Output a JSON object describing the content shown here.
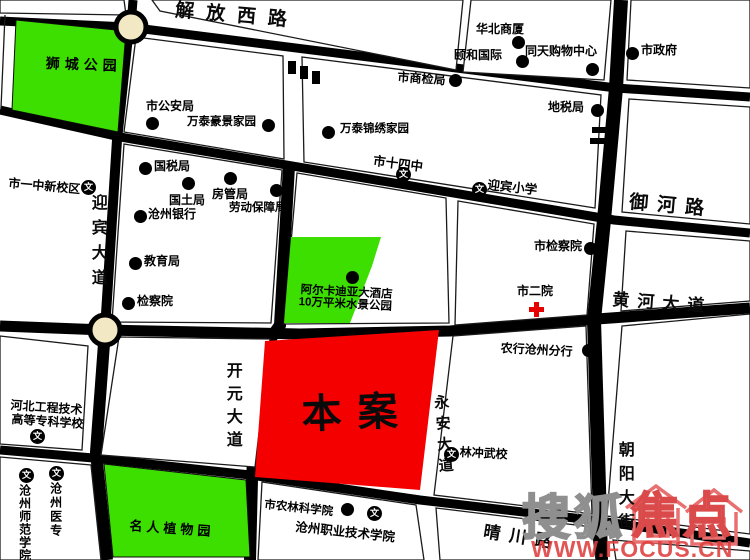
{
  "site": {
    "label": "本案"
  },
  "road_labels": {
    "jiefang": "解放西路",
    "yuhe": "御河路",
    "huanghe": "黄河大道",
    "qingchuan": "晴川路",
    "yingbin": "迎宾大道",
    "kaiyuan": "开元大道",
    "yongan": "永安大道",
    "chaoyang": "朝阳大街"
  },
  "parks": {
    "shicheng": "狮城公园",
    "mingren": "名人植物园"
  },
  "hotel": {
    "line1": "阿尔卡迪亚大酒店",
    "line2": "10万平米水景公园"
  },
  "pois": {
    "shi_gongan_ju": "市公安局",
    "wantai_haojing": "万泰豪景家园",
    "shi_shangjian_ju": "市商检局",
    "wantai_jinxiu": "万泰锦绣家园",
    "huabei_shangsha": "华北商厦",
    "yihe_guoji": "颐和国际",
    "tongtian_gouwu": "同天购物中心",
    "shi_zhengfu": "市政府",
    "dishui_ju": "地税局",
    "guoshui_ju": "国税局",
    "guotu_ju": "国土局",
    "fangguan_ju": "房管局",
    "laodong_baozhang_ju": "劳动保障局",
    "cangzhou_yinhang": "沧州银行",
    "jiaoyu_ju": "教育局",
    "jianchayuan": "检察院",
    "shi_jianchayuan": "市检察院",
    "nonghang_fenhang": "农行沧州分行",
    "shi_nonglin": "市农林科学院"
  },
  "hospital": {
    "label": "市二院"
  },
  "schools": {
    "icon_glyph": "文",
    "shiyizhong": "市一中新校区",
    "shisizhong": "市十四中",
    "yingbin_xiaoxue": "迎宾小学",
    "linchong_wuxiao": "林冲武校",
    "hebei_line1": "河北工程技术",
    "hebei_line2": "高等专科学校",
    "cangzhou_yizhuan": "沧州医专",
    "cangzhou_shifan": "沧州师范学院",
    "cangzhou_zhiye": "沧州职业技术学院"
  },
  "watermark": {
    "brand_left": "搜狐",
    "brand_right": "焦点",
    "url": "WWW.FOCUS.CN"
  },
  "colors": {
    "park_green": "#3CDF00",
    "site_red": "#F40000",
    "roundabout_fill": "#F2E9C4",
    "road_black": "#000000",
    "hospital_red": "#E60000",
    "watermark_red": "#DA4A4A",
    "watermark_gray": "#8F8F8F"
  }
}
